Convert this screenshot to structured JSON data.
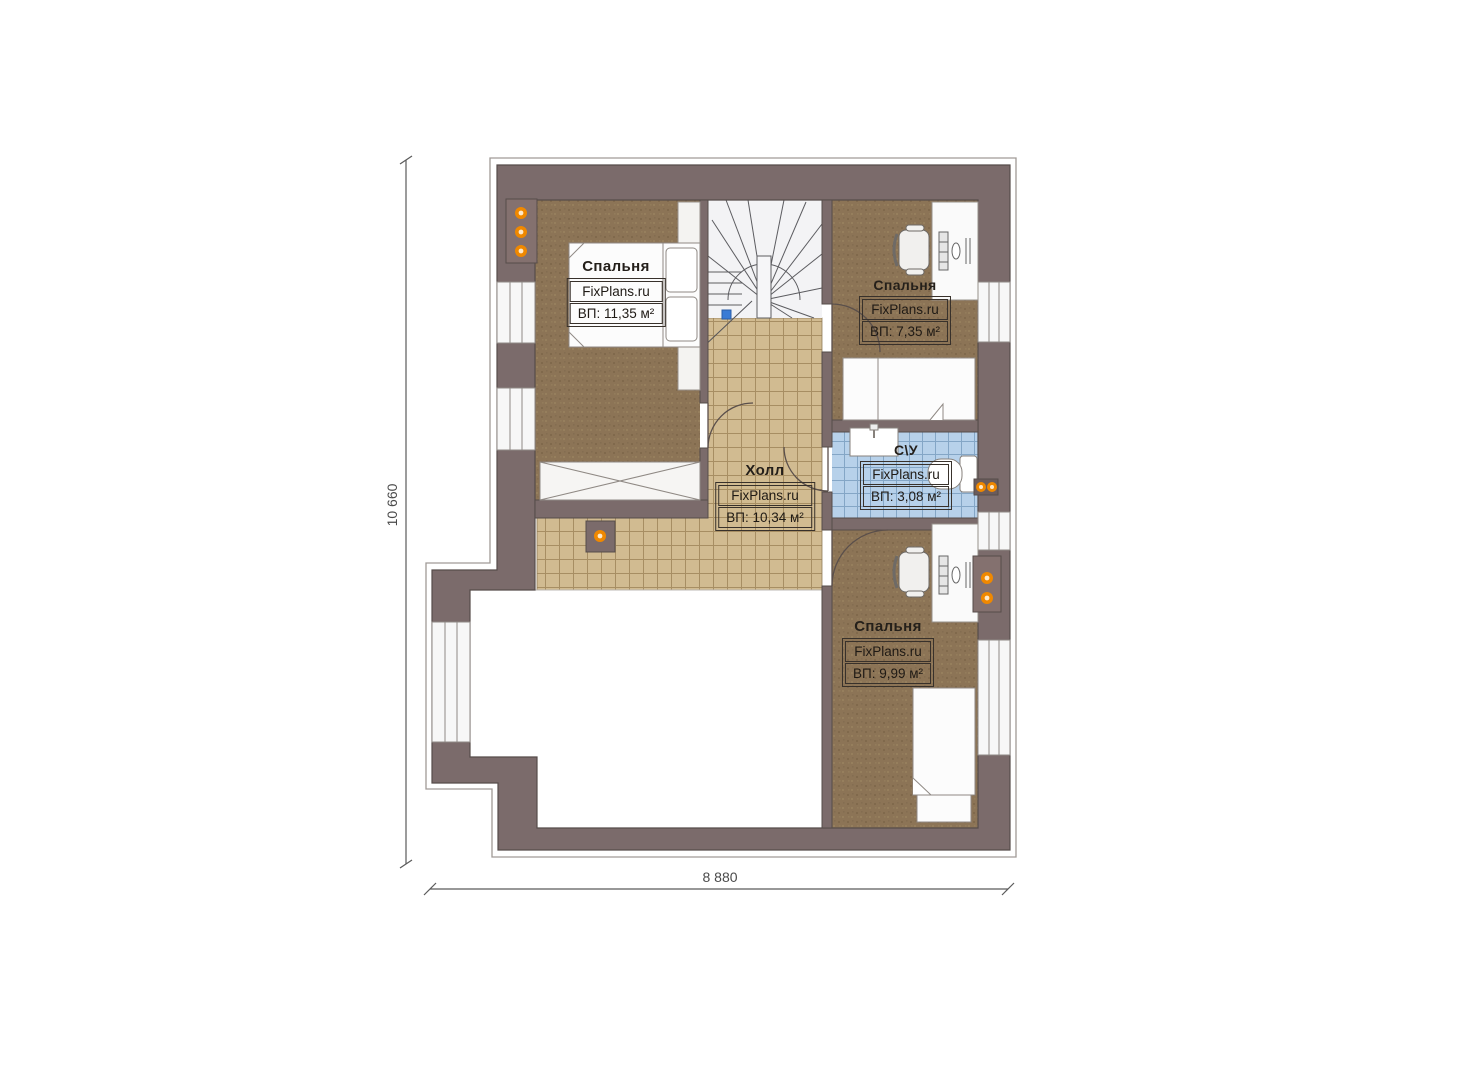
{
  "plan": {
    "brand": "FixPlans.ru",
    "rooms": {
      "bedroom1": {
        "name": "Спальня",
        "area": "ВП: 11,35 м²"
      },
      "bedroom2": {
        "name": "Спальня",
        "area": "ВП: 7,35 м²"
      },
      "bathroom": {
        "name": "С\\У",
        "area": "ВП: 3,08 м²"
      },
      "hall": {
        "name": "Холл",
        "area": "ВП: 10,34 м²"
      },
      "bedroom3": {
        "name": "Спальня",
        "area": "ВП: 9,99 м²"
      }
    },
    "dimensions": {
      "vertical": "10 660",
      "horizontal": "8 880"
    },
    "colors": {
      "wall": "#7b6b6b",
      "wall_outline": "#564c4a",
      "carpet": "#8c7456",
      "hall_tile": "#d1bb91",
      "wet_tile": "#b7d1ea",
      "accent_orange": "#ef8800",
      "stair_marker_blue": "#3a7bd5"
    }
  }
}
